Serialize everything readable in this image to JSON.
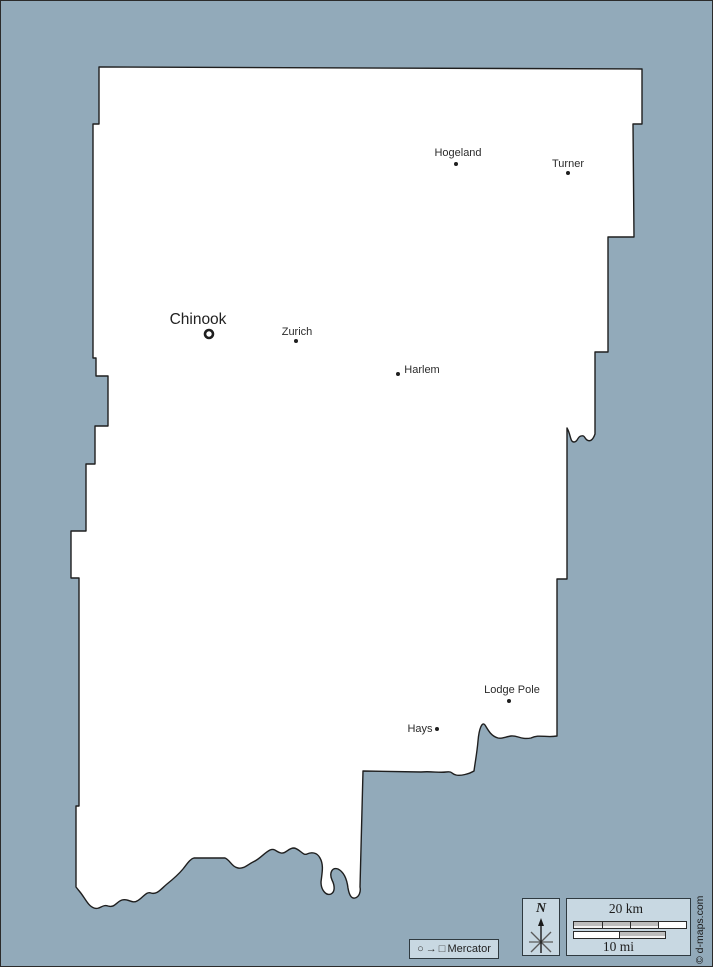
{
  "map": {
    "towns": [
      {
        "name": "Chinook",
        "marker": "county-seat-ring"
      },
      {
        "name": "Zurich",
        "marker": "dot"
      },
      {
        "name": "Harlem",
        "marker": "dot"
      },
      {
        "name": "Hogeland",
        "marker": "dot"
      },
      {
        "name": "Turner",
        "marker": "dot"
      },
      {
        "name": "Lodge Pole",
        "marker": "dot"
      },
      {
        "name": "Hays",
        "marker": "dot"
      }
    ]
  },
  "legend": {
    "compass_label": "N",
    "scale_km_label": "20 km",
    "scale_mi_label": "10 mi",
    "projection_label": "Mercator"
  },
  "icons": {
    "projection_circle": "○",
    "projection_arrow": "→",
    "projection_square": "□"
  },
  "credit": "© d-maps.com",
  "colors": {
    "background": "#92aaba",
    "land": "#ffffff",
    "outline": "#1f1f1f",
    "panel_fill": "#c8d8e2",
    "scalebar_gray": "#bdbdbd",
    "scalebar_white": "#ffffff"
  }
}
